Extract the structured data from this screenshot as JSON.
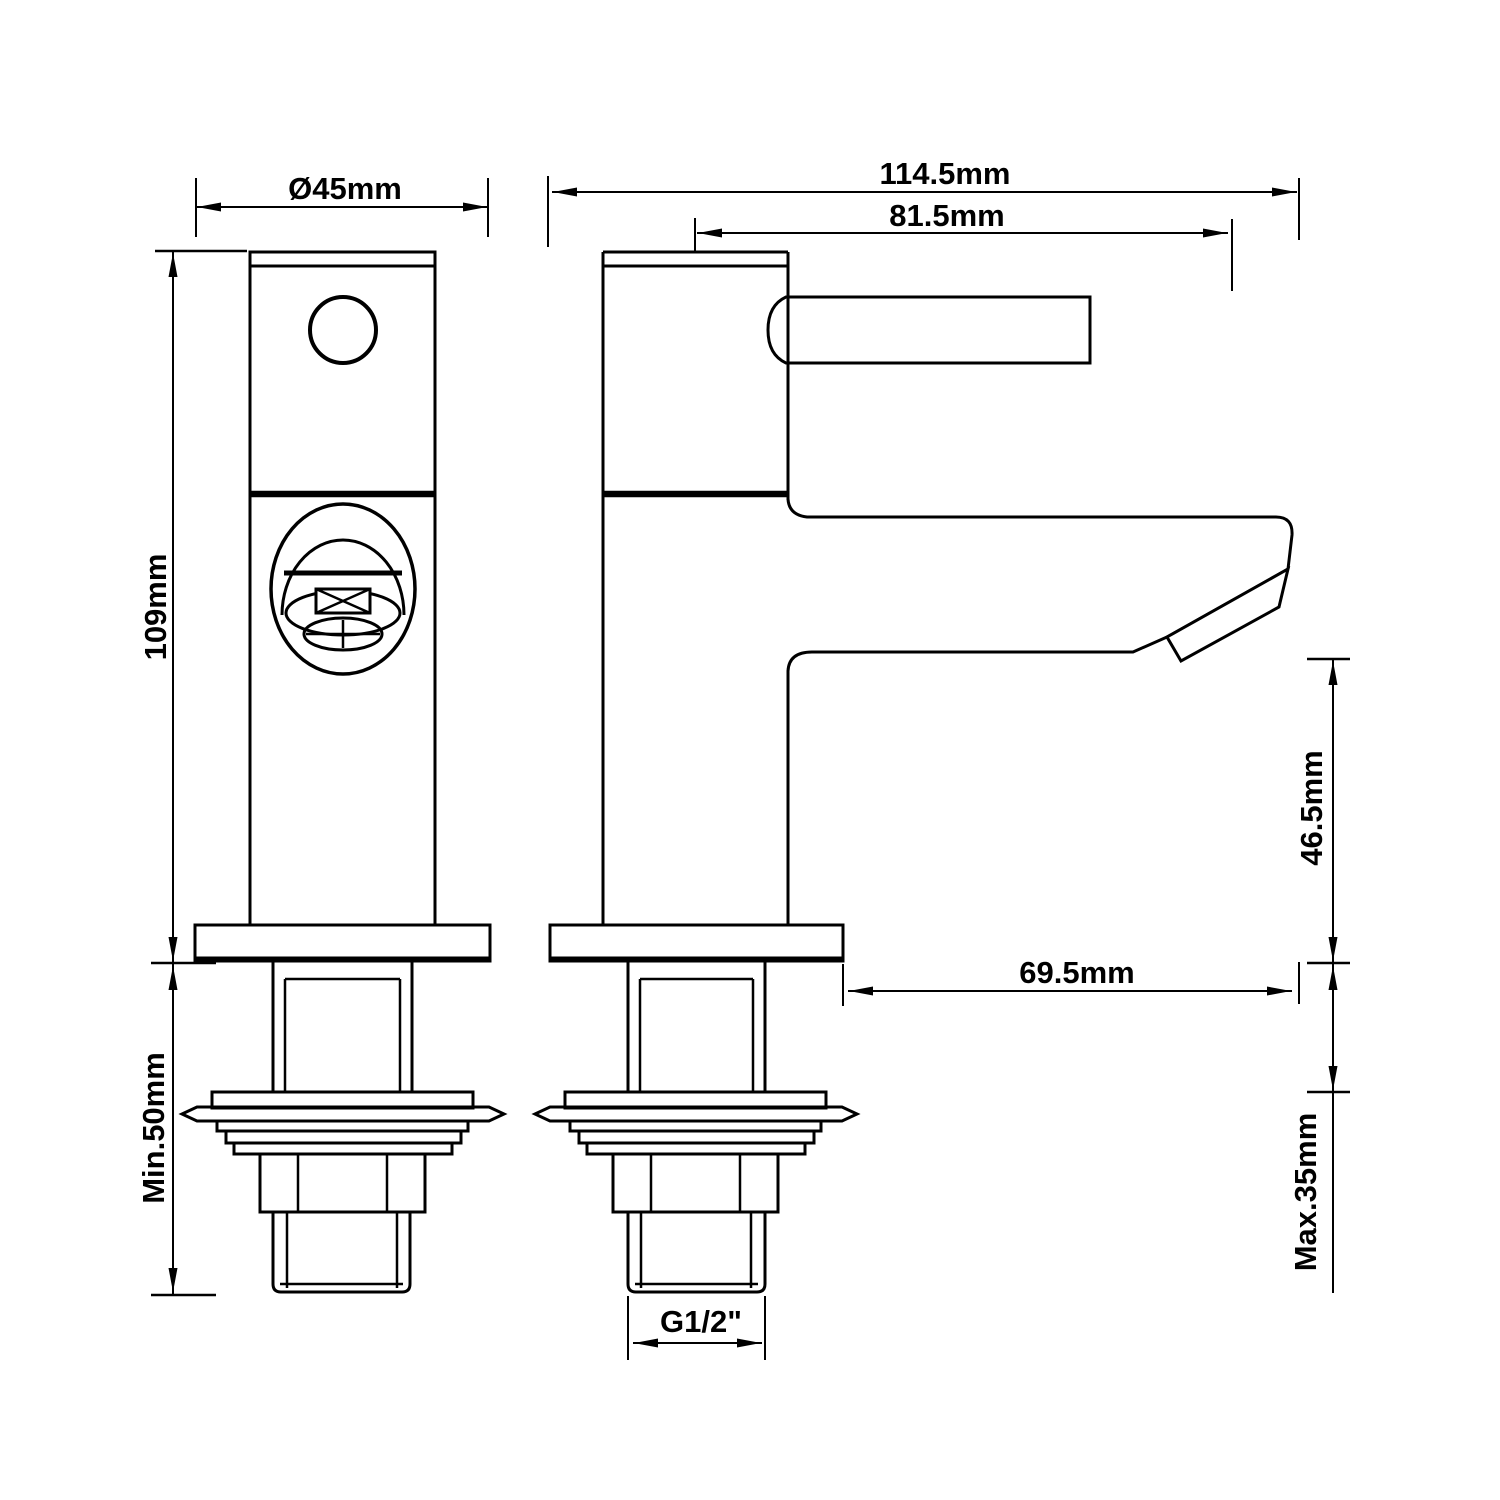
{
  "page": {
    "background": "#ffffff",
    "line_color": "#000000"
  },
  "views": {
    "front": "front-view-of-tap",
    "side": "side-view-of-tap"
  },
  "dimensions": {
    "base_diameter": "Ø45mm",
    "overall_reach": "114.5mm",
    "spout_center_reach": "81.5mm",
    "body_height": "109mm",
    "min_clearance": "Min.50mm",
    "spout_height": "46.5mm",
    "spout_reach": "69.5mm",
    "max_deck_thickness": "Max.35mm",
    "thread_size": "G1/2\""
  }
}
